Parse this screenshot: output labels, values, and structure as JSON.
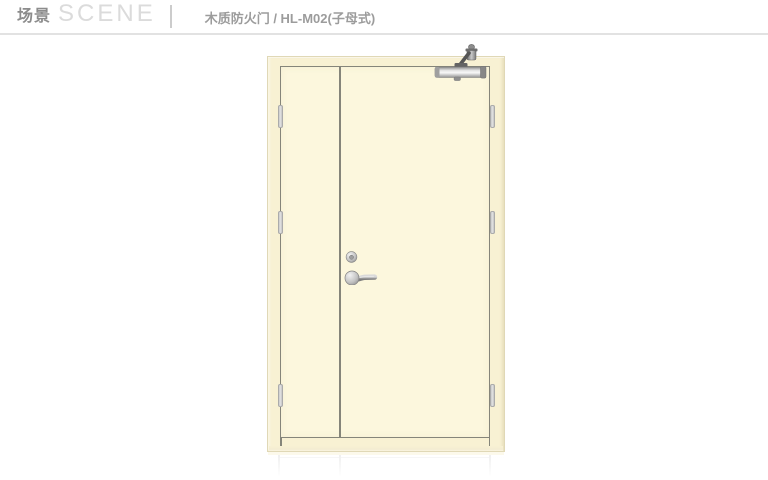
{
  "header": {
    "section_title_zh": "场景",
    "section_title_en": "SCENE",
    "product_title": "木质防火门 / HL-M02(子母式)"
  },
  "door": {
    "parts": [
      "door-frame",
      "leaf-child",
      "leaf-mother",
      "door-closer",
      "hinge",
      "lock-cylinder",
      "lever-handle",
      "floor-reflection"
    ]
  },
  "colors": {
    "background": "#FFFFFF",
    "door_surface": "#FCF7DD",
    "door_frame": "#F8F1D3",
    "frame_edge": "#E0D8B6",
    "outline": "#85857A",
    "hinge_fill": "#E3E3E3",
    "hinge_border": "#ABABAB",
    "header_zh": "#8C8C8C",
    "header_en": "#DBDBDB",
    "header_divider": "#CCCCCC",
    "product_title": "#9C9C9C",
    "rule": "#E2E2E2"
  }
}
